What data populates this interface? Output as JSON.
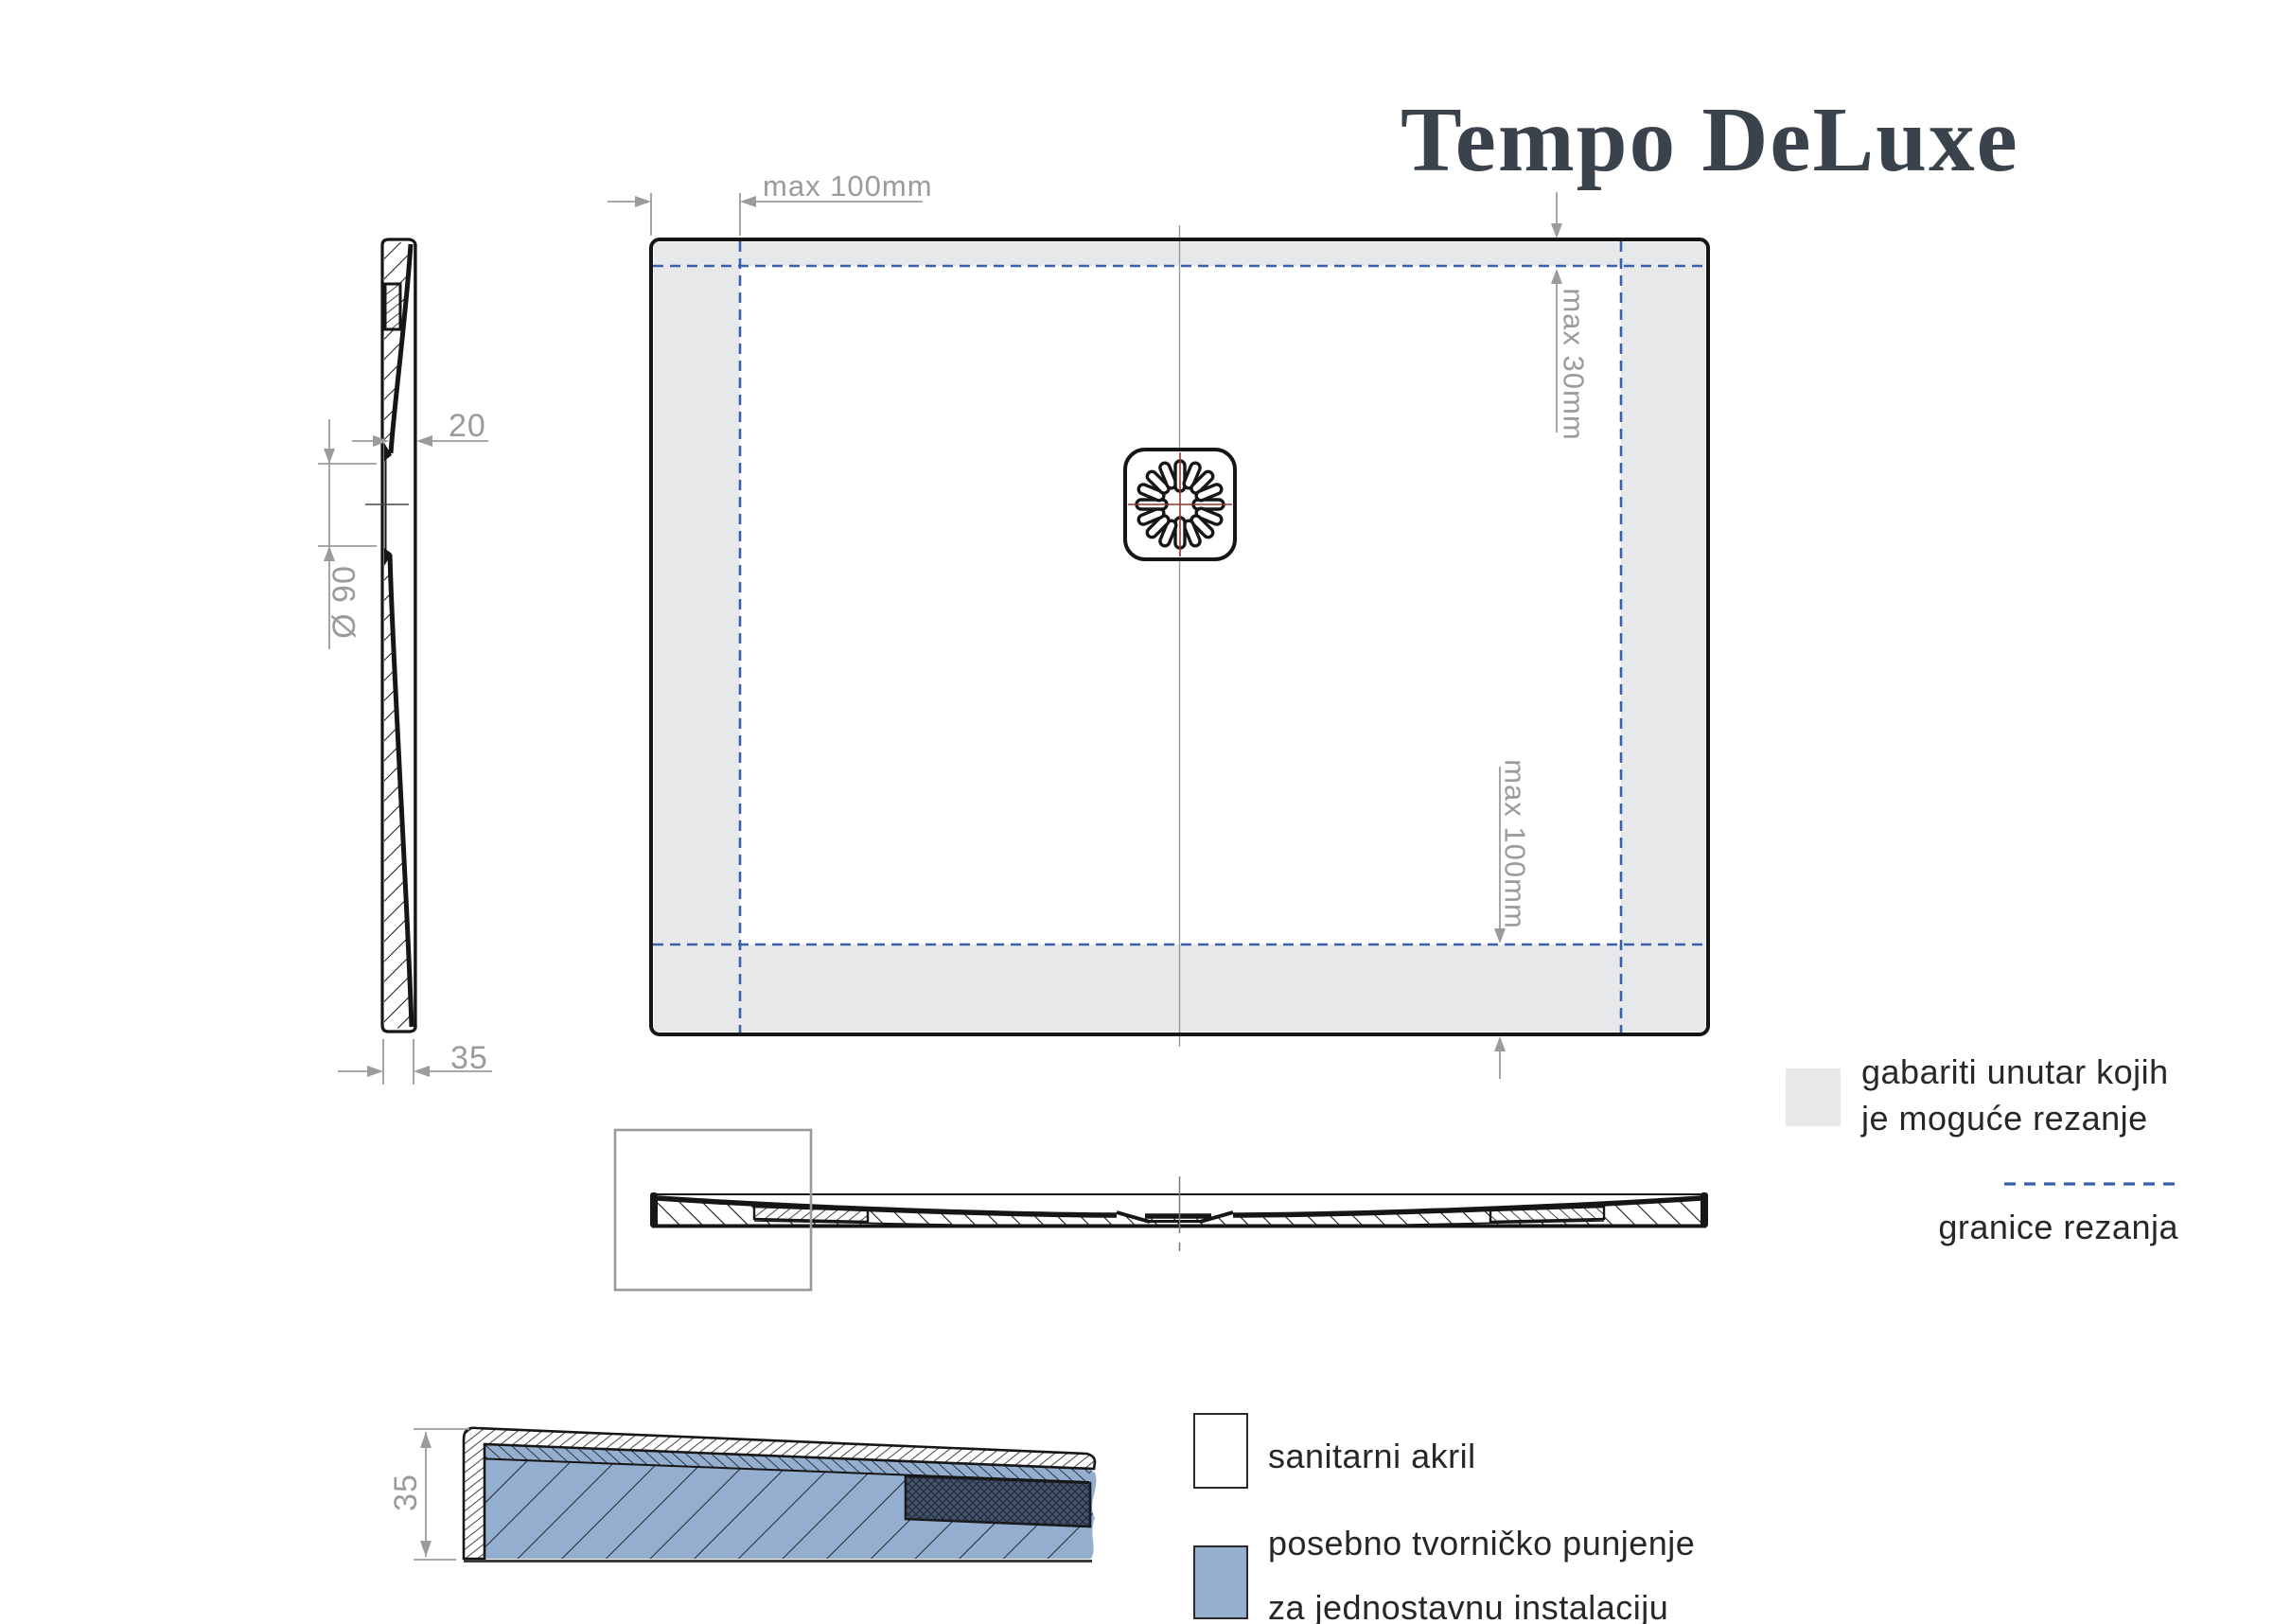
{
  "title": "Tempo DeLuxe",
  "plan_view": {
    "dim_top_margin": "max 100mm",
    "dim_right_top_margin": "max 30mm",
    "dim_bottom_margin": "max 100mm"
  },
  "profile_view": {
    "dim_center_thickness": "20",
    "dim_drain_diameter": "Ø 90",
    "dim_edge_thickness": "35"
  },
  "detail_view": {
    "dim_edge_height": "35"
  },
  "legend": {
    "cut_zone": {
      "label_line1": "gabariti unutar kojih",
      "label_line2": "je moguće rezanje",
      "swatch_color": "#e7e8ea"
    },
    "cut_limit": {
      "label": "granice rezanja",
      "line_color": "#3a5fad"
    },
    "acrylic": {
      "label": "sanitarni akril",
      "swatch_color": "#ffffff"
    },
    "factory_filling": {
      "label_line1": "posebno tvorničko punjenje",
      "label_line2": "za jednostavnu instalaciju",
      "swatch_color": "#94aed0"
    }
  },
  "colors": {
    "line_black": "#161616",
    "dim_gray": "#9b9b9b",
    "cut_zone_gray": "#e7e8ea",
    "cut_limit_blue": "#3a5fad",
    "filling_blue": "#94aed0",
    "filling_dark_blue": "#45546b",
    "drain_center_red": "#8a3a33",
    "title_color": "#3a434b"
  }
}
